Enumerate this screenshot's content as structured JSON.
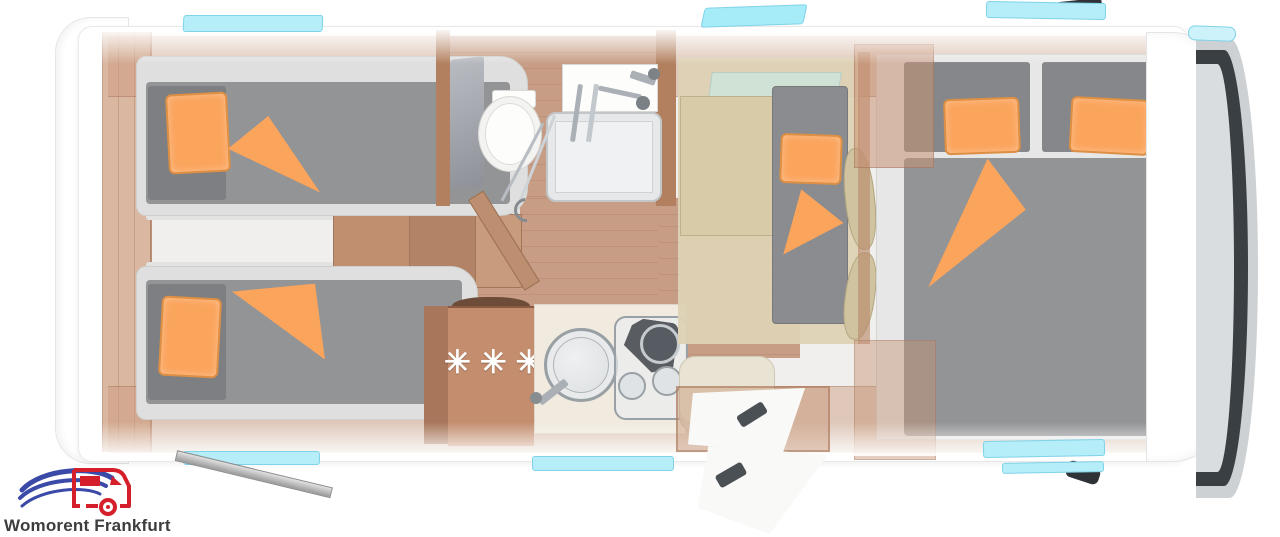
{
  "branding": {
    "name": "Womorent Frankfurt"
  },
  "floorplan": {
    "kitchen": {
      "fridge_symbol": "✳✳✳"
    },
    "colors": {
      "accent_orange": "#FBA45C",
      "mattress_gray": "#8F9092",
      "wood_floor": "#C79D85",
      "cabinet_wood": "#C38D6E",
      "window_cyan": "#B5EDF8",
      "upholstery_beige": "#D8CCA8",
      "windshield_dark": "#3A3F44",
      "logo_red": "#D5202C",
      "logo_blue": "#3B49A7"
    }
  }
}
